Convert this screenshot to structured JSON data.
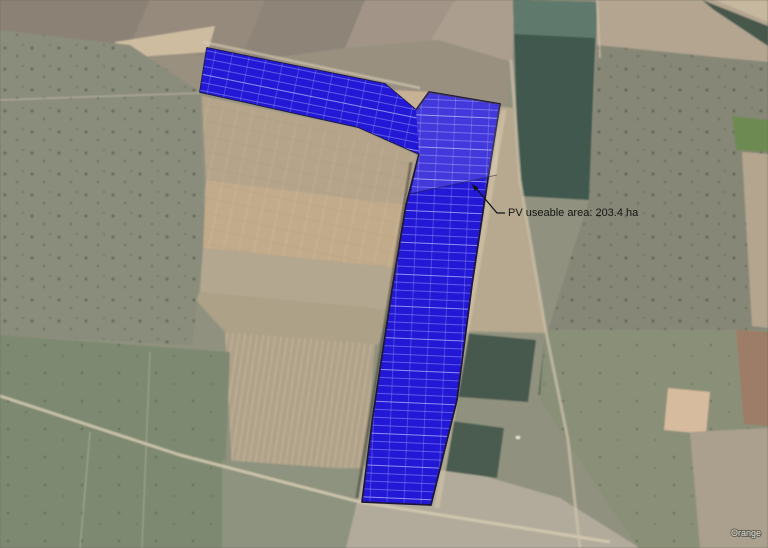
{
  "map": {
    "type": "satellite-imagery-with-pv-overlay",
    "watermark_label": "Orange",
    "pv_overlay": {
      "annotation_label": "PV useable area: 203.4 ha",
      "area_ha": 203.4,
      "fill_color": "#2318d6",
      "grid_line_color": "#aab2ff",
      "outline_color": "#1c1738"
    },
    "annotation": {
      "text_color": "#141414",
      "leader_color": "#111111"
    }
  }
}
